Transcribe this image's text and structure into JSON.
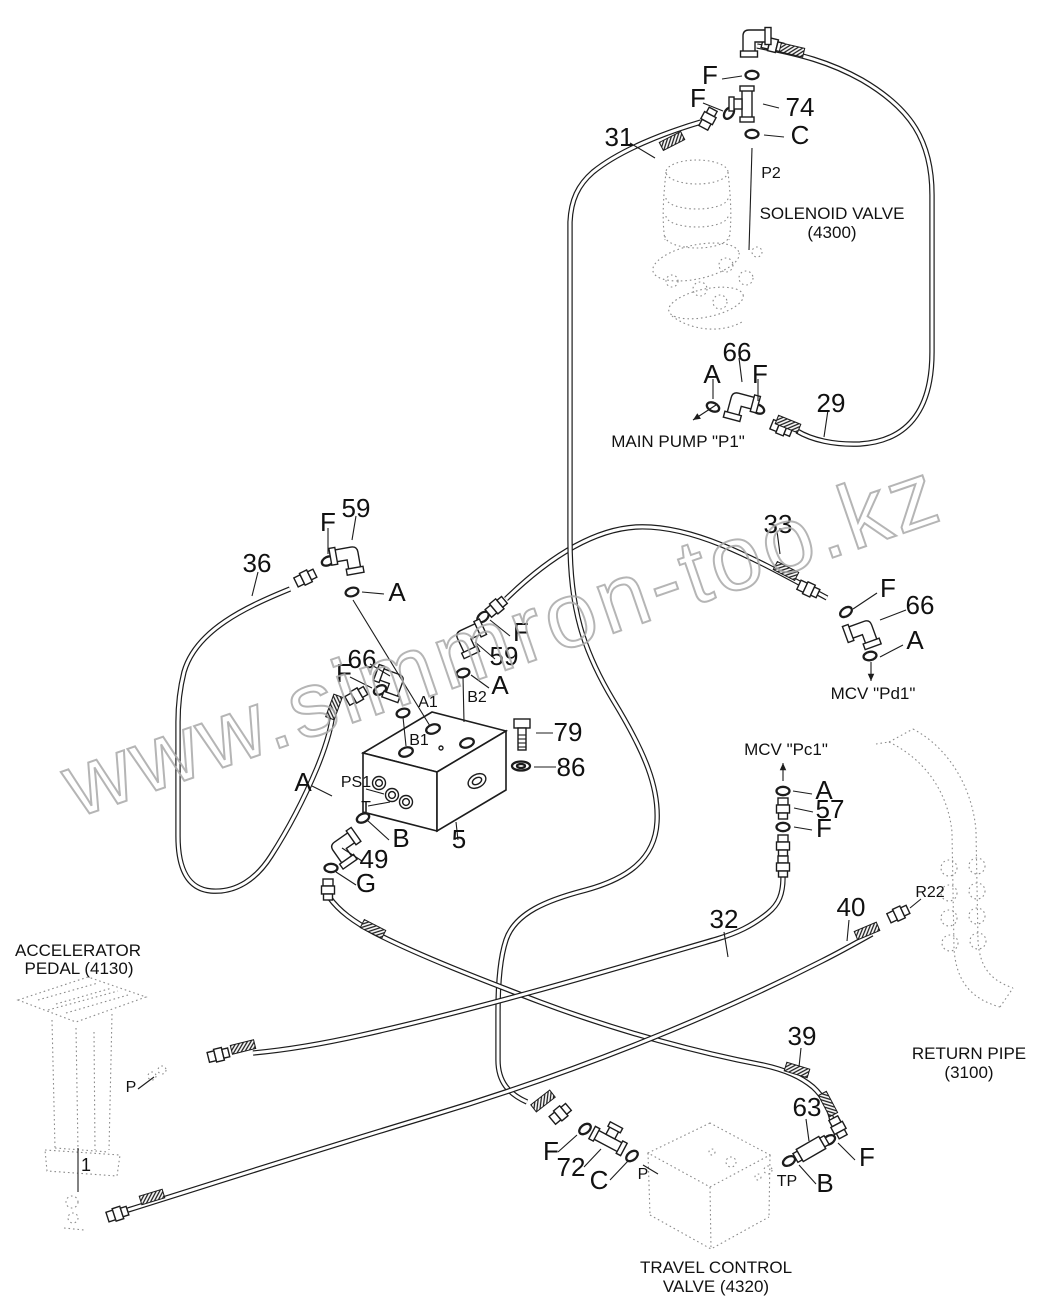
{
  "watermark": "www.simmron-too.kz",
  "colors": {
    "line": "#1c1c1c",
    "ghost": "#8b8b8b",
    "watermark": "#a9a9a9",
    "background": "#ffffff"
  },
  "component_labels": [
    {
      "id": "solenoid-valve-name",
      "t": "SOLENOID VALVE",
      "x": 832,
      "y": 219,
      "s": 17
    },
    {
      "id": "solenoid-valve-code",
      "t": "(4300)",
      "x": 832,
      "y": 238,
      "s": 17
    },
    {
      "id": "main-pump-name",
      "t": "MAIN PUMP \"P1\"",
      "x": 678,
      "y": 447,
      "s": 17
    },
    {
      "id": "mcv-pd1-name",
      "t": "MCV \"Pd1\"",
      "x": 873,
      "y": 699,
      "s": 17
    },
    {
      "id": "mcv-pc1-name",
      "t": "MCV \"Pc1\"",
      "x": 786,
      "y": 755,
      "s": 17
    },
    {
      "id": "accelerator-pedal-name",
      "t": "ACCELERATOR",
      "x": 78,
      "y": 956,
      "s": 17
    },
    {
      "id": "accelerator-pedal-code",
      "t": "PEDAL (4130)",
      "x": 79,
      "y": 974,
      "s": 17
    },
    {
      "id": "return-pipe-name",
      "t": "RETURN PIPE",
      "x": 969,
      "y": 1059,
      "s": 17
    },
    {
      "id": "return-pipe-code",
      "t": "(3100)",
      "x": 969,
      "y": 1078,
      "s": 17
    },
    {
      "id": "travel-valve-name",
      "t": "TRAVEL CONTROL",
      "x": 716,
      "y": 1273,
      "s": 17
    },
    {
      "id": "travel-valve-code",
      "t": "VALVE (4320)",
      "x": 716,
      "y": 1292,
      "s": 17
    }
  ],
  "callouts": [
    {
      "id": "f-top",
      "t": "F",
      "x": 710,
      "y": 84
    },
    {
      "id": "f-tee74",
      "t": "F",
      "x": 698,
      "y": 107
    },
    {
      "id": "74",
      "t": "74",
      "x": 800,
      "y": 116
    },
    {
      "id": "c-tee74",
      "t": "C",
      "x": 800,
      "y": 144
    },
    {
      "id": "31",
      "t": "31",
      "x": 619,
      "y": 146
    },
    {
      "id": "p2",
      "t": "P2",
      "x": 771,
      "y": 178,
      "s": 16
    },
    {
      "id": "66-p1",
      "t": "66",
      "x": 737,
      "y": 361
    },
    {
      "id": "a-p1",
      "t": "A",
      "x": 712,
      "y": 383
    },
    {
      "id": "f-p1",
      "t": "F",
      "x": 760,
      "y": 383
    },
    {
      "id": "29",
      "t": "29",
      "x": 831,
      "y": 412
    },
    {
      "id": "59-top",
      "t": "59",
      "x": 356,
      "y": 517
    },
    {
      "id": "f-59top",
      "t": "F",
      "x": 328,
      "y": 531
    },
    {
      "id": "36",
      "t": "36",
      "x": 257,
      "y": 572
    },
    {
      "id": "a-59top",
      "t": "A",
      "x": 397,
      "y": 601
    },
    {
      "id": "33",
      "t": "33",
      "x": 778,
      "y": 533
    },
    {
      "id": "f-pd1",
      "t": "F",
      "x": 888,
      "y": 597
    },
    {
      "id": "66-pd1",
      "t": "66",
      "x": 920,
      "y": 614
    },
    {
      "id": "a-pd1",
      "t": "A",
      "x": 915,
      "y": 649
    },
    {
      "id": "66-a1",
      "t": "66",
      "x": 362,
      "y": 668
    },
    {
      "id": "f-a1",
      "t": "F",
      "x": 344,
      "y": 682
    },
    {
      "id": "a1-port",
      "t": "A1",
      "x": 428,
      "y": 707,
      "s": 16
    },
    {
      "id": "f-b2",
      "t": "F",
      "x": 521,
      "y": 641
    },
    {
      "id": "59-b2",
      "t": "59",
      "x": 504,
      "y": 665
    },
    {
      "id": "a-b2",
      "t": "A",
      "x": 500,
      "y": 694
    },
    {
      "id": "b2-port",
      "t": "B2",
      "x": 477,
      "y": 702,
      "s": 16
    },
    {
      "id": "b1-port",
      "t": "B1",
      "x": 419,
      "y": 745,
      "s": 16
    },
    {
      "id": "79",
      "t": "79",
      "x": 568,
      "y": 741
    },
    {
      "id": "86",
      "t": "86",
      "x": 571,
      "y": 776
    },
    {
      "id": "a-ps1",
      "t": "A",
      "x": 303,
      "y": 791
    },
    {
      "id": "ps1-port",
      "t": "PS1",
      "x": 356,
      "y": 787,
      "s": 16
    },
    {
      "id": "t-port",
      "t": "T",
      "x": 366,
      "y": 812,
      "s": 16
    },
    {
      "id": "b-t",
      "t": "B",
      "x": 401,
      "y": 847
    },
    {
      "id": "5",
      "t": "5",
      "x": 459,
      "y": 848
    },
    {
      "id": "49",
      "t": "49",
      "x": 374,
      "y": 868
    },
    {
      "id": "g",
      "t": "G",
      "x": 366,
      "y": 892
    },
    {
      "id": "a-pc1",
      "t": "A",
      "x": 824,
      "y": 799
    },
    {
      "id": "57",
      "t": "57",
      "x": 830,
      "y": 818
    },
    {
      "id": "f-pc1",
      "t": "F",
      "x": 824,
      "y": 837
    },
    {
      "id": "32",
      "t": "32",
      "x": 724,
      "y": 928
    },
    {
      "id": "40",
      "t": "40",
      "x": 851,
      "y": 916
    },
    {
      "id": "r22-port",
      "t": "R22",
      "x": 930,
      "y": 897,
      "s": 16
    },
    {
      "id": "39",
      "t": "39",
      "x": 802,
      "y": 1045
    },
    {
      "id": "63",
      "t": "63",
      "x": 807,
      "y": 1116
    },
    {
      "id": "f-tp",
      "t": "F",
      "x": 867,
      "y": 1166
    },
    {
      "id": "tp-port",
      "t": "TP",
      "x": 787,
      "y": 1186,
      "s": 16
    },
    {
      "id": "b-tp",
      "t": "B",
      "x": 825,
      "y": 1192
    },
    {
      "id": "p-pedal",
      "t": "P",
      "x": 131,
      "y": 1092,
      "s": 16
    },
    {
      "id": "1",
      "t": "1",
      "x": 86,
      "y": 1171,
      "s": 18
    },
    {
      "id": "f-72",
      "t": "F",
      "x": 551,
      "y": 1160
    },
    {
      "id": "72",
      "t": "72",
      "x": 571,
      "y": 1176
    },
    {
      "id": "c-72",
      "t": "C",
      "x": 599,
      "y": 1189
    },
    {
      "id": "p-72",
      "t": "P",
      "x": 643,
      "y": 1179,
      "s": 16
    }
  ]
}
